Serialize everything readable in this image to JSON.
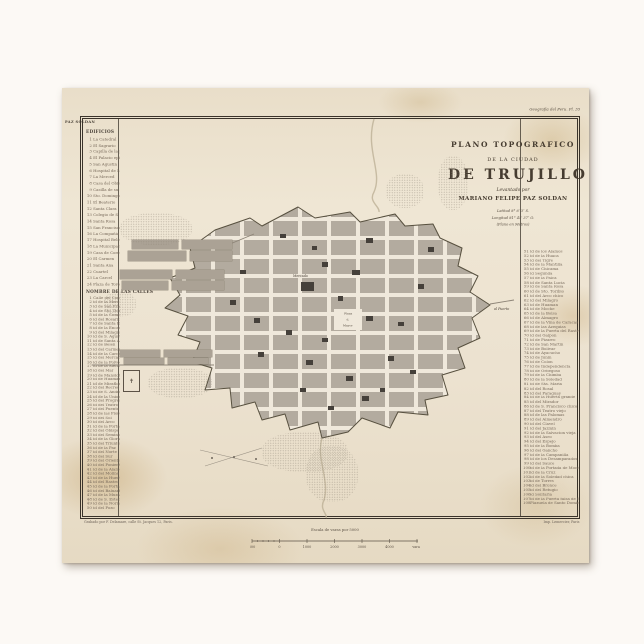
{
  "plate": {
    "left": "PAZ SOLDAN",
    "right": "Geografia del Peru. Pl. 35"
  },
  "title": {
    "line1": "PLANO TOPOGRAFICO",
    "line2": "DE LA CIUDAD",
    "line3": "DE TRUJILLO",
    "line4": "Levantado por",
    "line5": "MARIANO FELIPE PAZ SOLDAN",
    "coords": [
      "Latitud 8° 6′ 3″ S.",
      "Longitud 81° 45′ 37″ O.",
      "(Plano en Metros)"
    ]
  },
  "legend_left": {
    "header": "EDIFICIOS",
    "buildings": [
      [
        1,
        "La Catedral"
      ],
      [
        2,
        "El Sagrario"
      ],
      [
        3,
        "Capilla de la prision de la Sierra"
      ],
      [
        4,
        "El Palacio episcopal"
      ],
      [
        5,
        "San Agustin"
      ],
      [
        6,
        "Hospital de Mujeres"
      ],
      [
        7,
        "La Merced"
      ],
      [
        8,
        "Casa del Obispo"
      ],
      [
        9,
        "Casilla de su capilla y los altos"
      ],
      [
        10,
        "Sto. Domingo"
      ],
      [
        11,
        "El Beaterio"
      ],
      [
        12,
        "Santa Clara"
      ],
      [
        13,
        "Colegio de S. Carlos"
      ],
      [
        14,
        "Santa Rosa"
      ],
      [
        15,
        "San Francisco"
      ],
      [
        16,
        "La Compañia"
      ],
      [
        17,
        "Hospital Belen"
      ],
      [
        18,
        "La Municipalidad"
      ],
      [
        19,
        "Casa de Correos"
      ],
      [
        20,
        "El Carmen"
      ],
      [
        21,
        "Santa Ana"
      ],
      [
        22,
        "Cuartel"
      ],
      [
        23,
        "La Carcel"
      ],
      [
        24,
        "Plaza de Toros"
      ]
    ],
    "streets_header": "NOMBRE DE LAS CALLES",
    "streets": [
      [
        1,
        "Calle del Comercio"
      ],
      [
        2,
        "id de la Merced"
      ],
      [
        3,
        "id de San Francisco"
      ],
      [
        4,
        "id de Sto. Domingo"
      ],
      [
        5,
        "id de la Compañia"
      ],
      [
        6,
        "id del Rosario"
      ],
      [
        7,
        "id de Santa Rosa"
      ],
      [
        8,
        "id de la Encarnacion"
      ],
      [
        9,
        "id del Milagro"
      ],
      [
        10,
        "id de S. Agustin"
      ],
      [
        11,
        "id de Santa Ana"
      ],
      [
        12,
        "id de Belen"
      ],
      [
        13,
        "id del Carmen"
      ],
      [
        14,
        "id de la Carcel"
      ],
      [
        15,
        "id del Mercado"
      ],
      [
        16,
        "id de la Polvora"
      ],
      [
        17,
        "id de la Sierra"
      ],
      [
        18,
        "id del Mar"
      ],
      [
        19,
        "id de Mansiche"
      ],
      [
        20,
        "id de Huaman"
      ],
      [
        21,
        "id de Miraflores"
      ],
      [
        22,
        "id del Recreo"
      ],
      [
        23,
        "id de S. Andres"
      ],
      [
        24,
        "id de la Union"
      ],
      [
        25,
        "id del Progreso"
      ],
      [
        26,
        "id del Teatro"
      ],
      [
        27,
        "id del Puente"
      ],
      [
        28,
        "id de las Flores"
      ],
      [
        29,
        "id del Sol"
      ],
      [
        30,
        "id del Arco"
      ],
      [
        31,
        "id de la Portada"
      ],
      [
        32,
        "id del Obispo"
      ],
      [
        33,
        "id del Seminario"
      ],
      [
        34,
        "id de la Gloria"
      ],
      [
        35,
        "id del Triunfo"
      ],
      [
        36,
        "id de la Paz"
      ],
      [
        37,
        "id del Norte"
      ],
      [
        38,
        "id del Sur"
      ],
      [
        39,
        "id del Oriente"
      ],
      [
        40,
        "id del Poniente"
      ],
      [
        41,
        "id de la Alameda"
      ],
      [
        42,
        "id del Molino"
      ],
      [
        43,
        "id de la Huerta"
      ],
      [
        44,
        "id del Rastro"
      ],
      [
        45,
        "id de la Fortaleza"
      ],
      [
        46,
        "id del Baluarte"
      ],
      [
        47,
        "id de la Muralla"
      ],
      [
        48,
        "id de S. Esteban"
      ],
      [
        49,
        "id de la Noria"
      ],
      [
        50,
        "id del Pozo"
      ]
    ]
  },
  "legend_right": {
    "streets": [
      [
        51,
        "id de los Alamos"
      ],
      [
        52,
        "id de la Huaca"
      ],
      [
        53,
        "id del Tigre"
      ],
      [
        54,
        "id de la Mantilla"
      ],
      [
        55,
        "id de Chicama"
      ],
      [
        56,
        "id Segunda"
      ],
      [
        57,
        "id de la Palca"
      ],
      [
        58,
        "id de Santa Lucia"
      ],
      [
        59,
        "id de Santa Rosa"
      ],
      [
        60,
        "id de Sto. Toribio"
      ],
      [
        61,
        "id del Arco chico"
      ],
      [
        62,
        "id del Milagro"
      ],
      [
        63,
        "id de Huaman"
      ],
      [
        64,
        "id de Moche"
      ],
      [
        65,
        "id de la Bolsa"
      ],
      [
        66,
        "id de Almagro"
      ],
      [
        67,
        "id de la Viña de Caracas"
      ],
      [
        68,
        "id de las Azequias"
      ],
      [
        69,
        "id de la Puerta del Rastro"
      ],
      [
        70,
        "id del Galpon"
      ],
      [
        71,
        "id de Pizarro"
      ],
      [
        72,
        "id de San Martin"
      ],
      [
        73,
        "id de Bolivar"
      ],
      [
        74,
        "id de Ayacucho"
      ],
      [
        75,
        "id de Junin"
      ],
      [
        76,
        "id de Colon"
      ],
      [
        77,
        "id de Independencia"
      ],
      [
        78,
        "id de Orbegoso"
      ],
      [
        79,
        "id de la Chimba"
      ],
      [
        80,
        "id de la Soledad"
      ],
      [
        81,
        "id de Sta. Maria"
      ],
      [
        82,
        "id del Rosal"
      ],
      [
        83,
        "id del Paraguay"
      ],
      [
        84,
        "id de la Huerta grande"
      ],
      [
        85,
        "id del Mirador"
      ],
      [
        86,
        "id de S. Francisco chico"
      ],
      [
        87,
        "id del Teatro viejo"
      ],
      [
        88,
        "id de las Palomas"
      ],
      [
        89,
        "id del Almendro"
      ],
      [
        90,
        "id del Clavel"
      ],
      [
        91,
        "id del Jazmin"
      ],
      [
        92,
        "id de la Salvacion vieja"
      ],
      [
        93,
        "id del Aseo"
      ],
      [
        94,
        "id del Espejo"
      ],
      [
        95,
        "id de la Bomba"
      ],
      [
        96,
        "id del Gancho"
      ],
      [
        97,
        "id de la Campanilla"
      ],
      [
        98,
        "id de los Desamparados"
      ],
      [
        99,
        "id del Sauce"
      ],
      [
        100,
        "id de la Portada de Moche"
      ],
      [
        101,
        "id de la Cruz"
      ],
      [
        102,
        "id de la Soledad chica"
      ],
      [
        103,
        "id de Torres"
      ],
      [
        104,
        "id del Bronce"
      ],
      [
        105,
        "id del Refugio"
      ],
      [
        106,
        "id Solitaria"
      ],
      [
        107,
        "id de la Puerta falsa de Santo Domingo"
      ],
      [
        108,
        "Plazuela de Santo Domingo"
      ]
    ]
  },
  "map_labels": {
    "mercado": "Mercado",
    "plaza1": "Plaza",
    "plaza2": "d.",
    "plaza3": "Mayor",
    "al_puerto": "al Puerto",
    "cross": "✝"
  },
  "scale": {
    "label": "Escala de varas por 5000",
    "ticks": [
      "500",
      "0",
      "1000",
      "2000",
      "3000",
      "4000",
      "varas"
    ]
  },
  "imprint": {
    "left": "Grabado por F. Delamare, calle St. Jacques 12, Paris.",
    "right": "Imp. Lemercier, Paris"
  },
  "colors": {
    "paper": "#ece2d0",
    "block_gray": "#b3ab9f",
    "street": "#efe8db",
    "building_dark": "#45403a",
    "frame_ink": "#3a332a"
  },
  "map": {
    "wall": "153,142 188,130 200,138 236,119 253,130 288,124 298,134 333,126 343,138 371,136 378,150 400,160 396,178 416,188 408,204 428,217 410,230 418,250 396,260 403,280 380,287 386,307 363,312 366,327 336,324 328,340 300,330 286,344 260,350 256,334 228,342 223,326 200,332 193,314 170,320 168,300 143,302 150,280 130,274 138,254 116,247 126,228 103,220 118,207 108,190 133,180 128,160",
    "rivers": [
      "M312,31 C303,62 321,84 312,104 C306,114 318,118 317,124",
      "M260,350 C254,372 268,392 262,412 C257,422 266,426 264,430"
    ],
    "roads": [
      [
        30,
        277,
        152,
        277
      ],
      [
        168,
        156,
        192,
        146
      ],
      [
        428,
        216,
        452,
        212
      ]
    ],
    "diagonals": [
      [
        138,
        362,
        206,
        378
      ],
      [
        143,
        378,
        200,
        360
      ]
    ],
    "dots": [
      [
        150,
        370
      ],
      [
        172,
        369
      ],
      [
        194,
        371
      ]
    ],
    "suburbs": [
      [
        70,
        152,
        46,
        9
      ],
      [
        120,
        152,
        50,
        9
      ],
      [
        66,
        163,
        58,
        10
      ],
      [
        128,
        163,
        42,
        10
      ],
      [
        58,
        182,
        52,
        9
      ],
      [
        114,
        182,
        48,
        9
      ],
      [
        60,
        193,
        46,
        9
      ],
      [
        110,
        193,
        52,
        9
      ],
      [
        58,
        262,
        40,
        7
      ],
      [
        102,
        262,
        48,
        7
      ],
      [
        62,
        270,
        40,
        6
      ],
      [
        106,
        270,
        40,
        6
      ]
    ],
    "fields": [
      [
        58,
        125,
        72,
        32
      ],
      [
        42,
        203,
        32,
        26
      ],
      [
        86,
        280,
        64,
        30
      ],
      [
        324,
        86,
        38,
        34
      ],
      [
        376,
        68,
        30,
        54
      ],
      [
        200,
        344,
        86,
        40
      ],
      [
        244,
        358,
        52,
        56
      ]
    ],
    "buildings": [
      [
        304,
        150,
        7,
        5
      ],
      [
        366,
        159,
        6,
        5
      ],
      [
        260,
        174,
        6,
        5
      ],
      [
        290,
        182,
        8,
        5
      ],
      [
        356,
        196,
        6,
        5
      ],
      [
        276,
        208,
        5,
        5
      ],
      [
        168,
        212,
        6,
        5
      ],
      [
        192,
        230,
        6,
        5
      ],
      [
        304,
        228,
        7,
        5
      ],
      [
        336,
        234,
        6,
        4
      ],
      [
        224,
        242,
        6,
        5
      ],
      [
        260,
        250,
        6,
        4
      ],
      [
        196,
        264,
        6,
        5
      ],
      [
        244,
        272,
        7,
        5
      ],
      [
        326,
        268,
        6,
        5
      ],
      [
        284,
        288,
        7,
        5
      ],
      [
        238,
        300,
        6,
        4
      ],
      [
        300,
        308,
        7,
        5
      ],
      [
        348,
        282,
        6,
        4
      ],
      [
        178,
        182,
        6,
        4
      ],
      [
        218,
        146,
        6,
        4
      ],
      [
        250,
        158,
        5,
        4
      ],
      [
        266,
        318,
        6,
        4
      ],
      [
        318,
        300,
        5,
        4
      ],
      [
        239,
        194,
        13,
        9
      ]
    ]
  }
}
